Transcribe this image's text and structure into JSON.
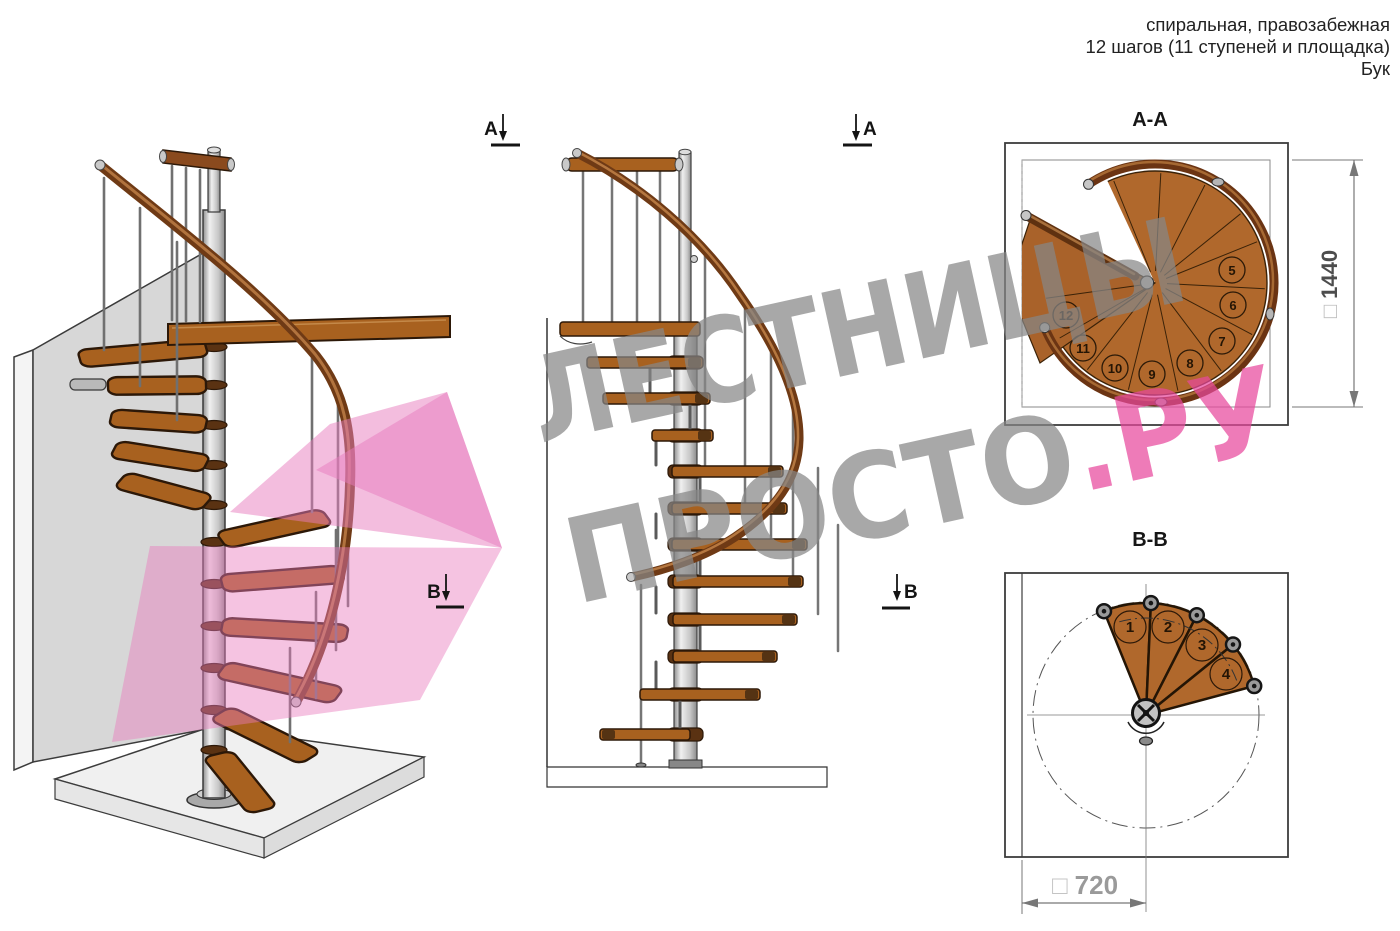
{
  "header": {
    "line1": "спиральная, правозабежная",
    "line2": "12 шагов (11 ступеней и площадка)",
    "line3": "Бук"
  },
  "watermark": {
    "word1": "ЛЕСТНИЦЫ",
    "word2": "ПРОСТО",
    "word3": ".РУ"
  },
  "section_markers": {
    "a": "А",
    "b": "В"
  },
  "views": {
    "iso": {
      "description": "3D вид спиральной лестницы"
    },
    "elevation": {
      "description": "вид сбоку"
    },
    "plan_aa": {
      "title": "А-А",
      "dim_symbol": "□",
      "dim_value": "1440",
      "step_numbers": [
        "5",
        "6",
        "7",
        "8",
        "9",
        "10",
        "11",
        "12"
      ]
    },
    "plan_bb": {
      "title": "В-В",
      "dim_symbol": "□",
      "dim_value": "720",
      "step_numbers": [
        "1",
        "2",
        "3",
        "4"
      ]
    }
  },
  "colors": {
    "wood": "#a8611f",
    "handrail": "#6f3a15",
    "metal": "#c0c0c0",
    "wall": "#d7d7d7",
    "watermark_gray": "#878787",
    "watermark_pink": "#e8489c",
    "overlay_pink": "#e87bbd"
  }
}
